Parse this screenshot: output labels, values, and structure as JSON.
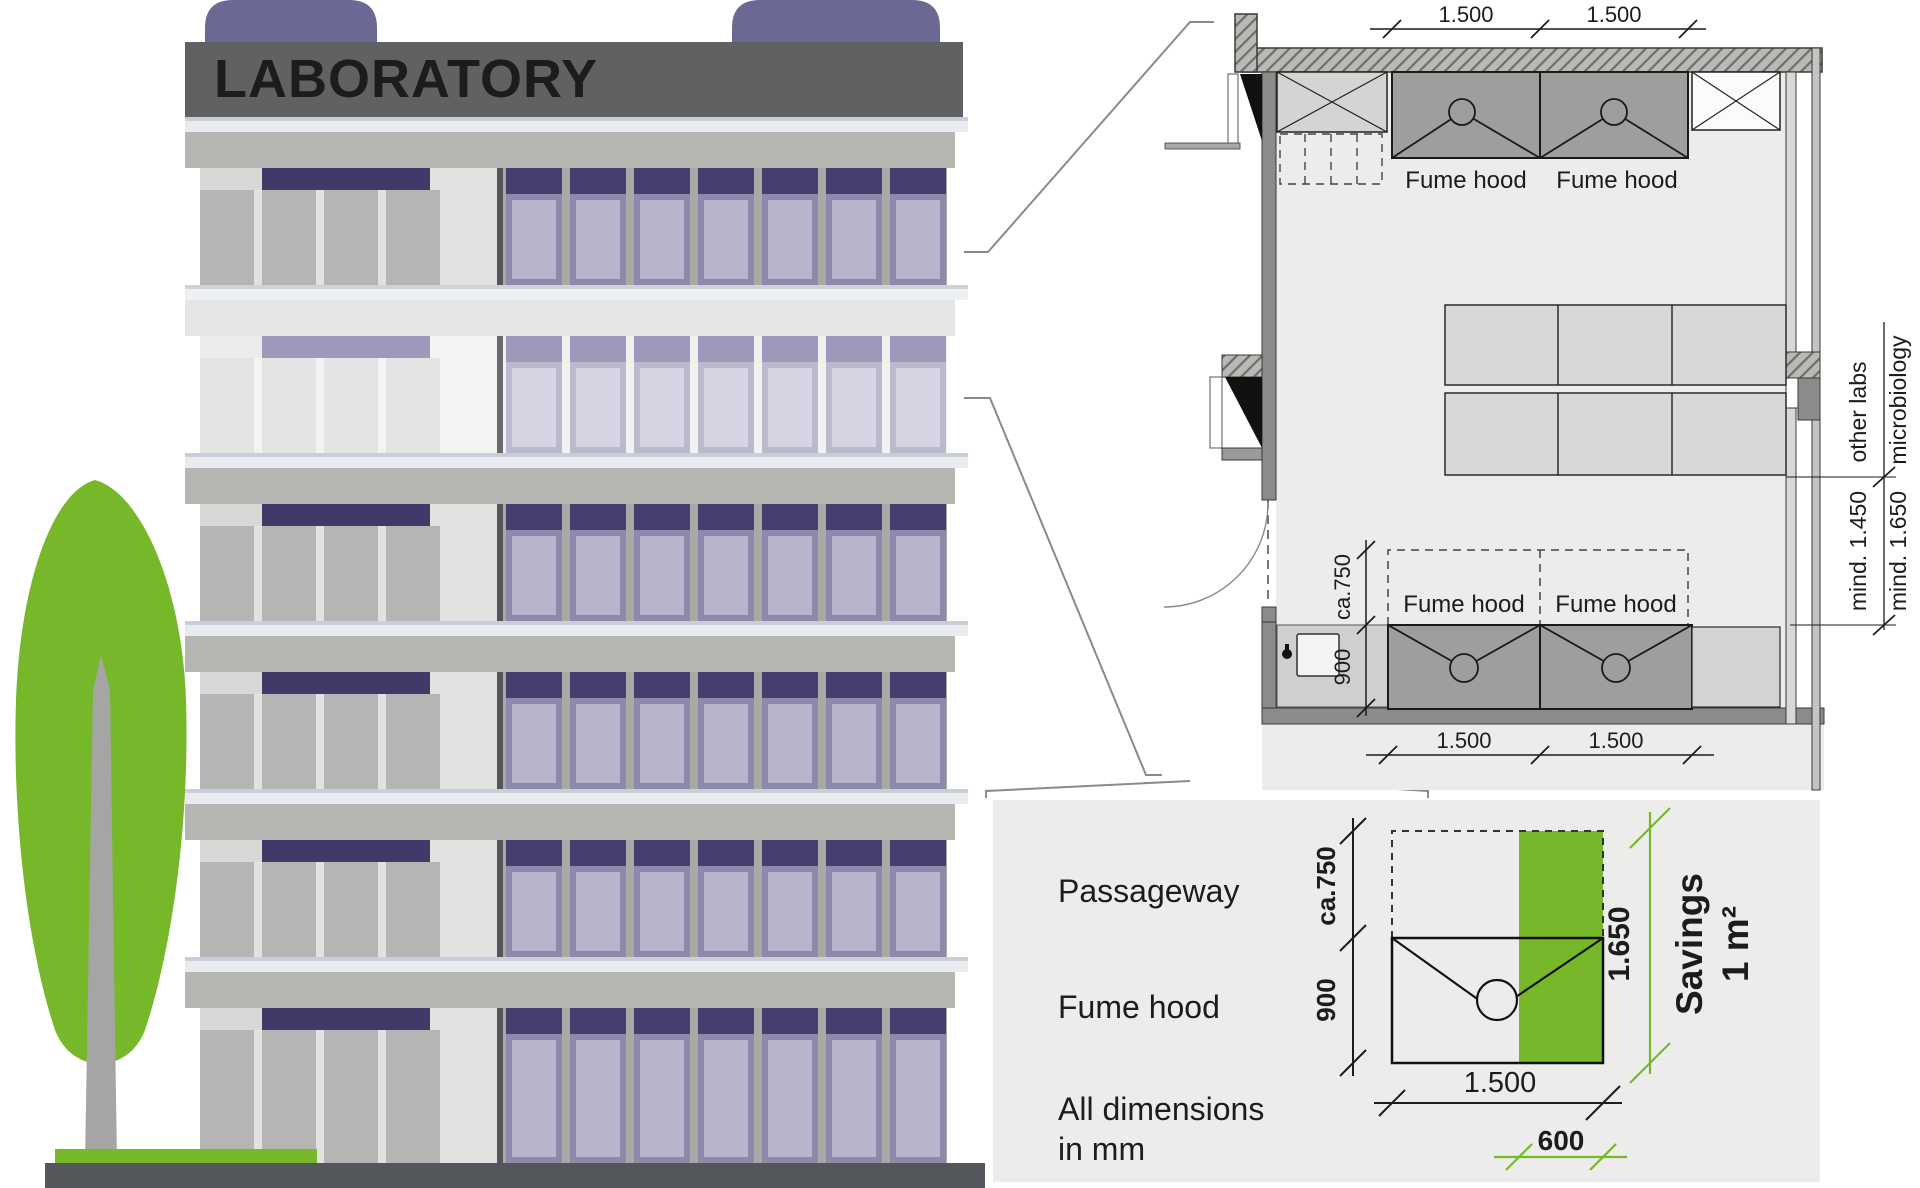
{
  "building": {
    "sign": "LABORATORY"
  },
  "plan": {
    "dims_top": [
      "1.500",
      "1.500"
    ],
    "dims_bottom": [
      "1.500",
      "1.500"
    ],
    "hood_labels_top": [
      "Fume hood",
      "Fume hood"
    ],
    "hood_labels_bottom": [
      "Fume hood",
      "Fume hood"
    ],
    "dim_passage": "ca.750",
    "dim_depth": "900",
    "adjacent_labels": [
      "other labs",
      "microbiology"
    ],
    "clearance_labels": [
      "mind. 1.450",
      "mind. 1.650"
    ]
  },
  "detail": {
    "legend_passageway": "Passageway",
    "legend_fume_hood": "Fume hood",
    "note_line1": "All dimensions",
    "note_line2": "in mm",
    "dim_passage": "ca.750",
    "dim_depth": "900",
    "dim_width": "1.500",
    "dim_total": "1.650",
    "dim_saving_width": "600",
    "savings_line1": "Savings",
    "savings_line2": "1 m²"
  },
  "colors": {
    "accent_green": "#76b82a",
    "sign_bg": "#5f6163",
    "sign_text": "#ffffff",
    "roof_purple": "#6c6894",
    "window_header_purple": "#453e6e",
    "window_frame_purple": "#8e89ab",
    "window_pane_purple": "#b8b4cb",
    "faded_header_purple": "#9e99ba",
    "faded_frame_purple": "#bcb8cd",
    "faded_pane_purple": "#d6d4e3",
    "facade_gray": "#b5b6b2",
    "slab_light": "#e9ecef",
    "ground_gray": "#53565a",
    "tree_trunk_gray": "#a5a5a3",
    "plan_bg": "#ececea",
    "wall_gray": "#8b8b89",
    "hood_gray": "#9e9e9c",
    "line_dark": "#1c1c1c"
  }
}
